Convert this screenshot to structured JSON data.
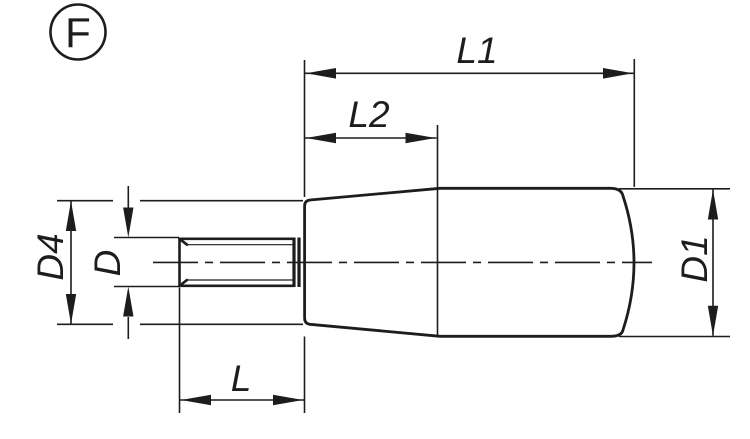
{
  "drawing": {
    "view_label": "F",
    "dimension_labels": {
      "l1": "L1",
      "l2": "L2",
      "l": "L",
      "d": "D",
      "d4": "D4",
      "d1": "D1"
    },
    "colors": {
      "line": "#1d1d1b",
      "background": "#ffffff"
    }
  }
}
